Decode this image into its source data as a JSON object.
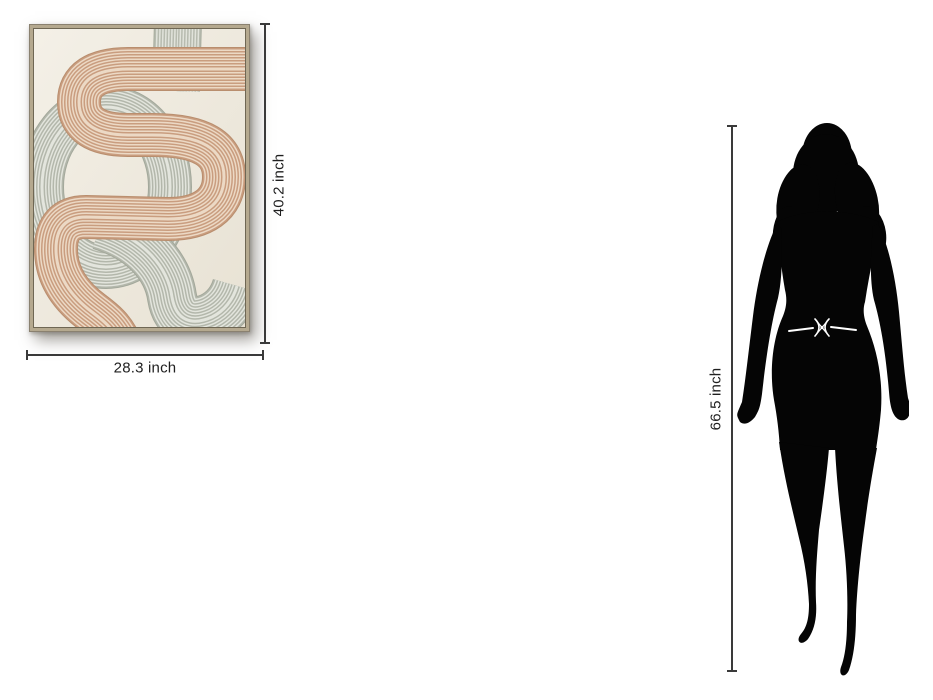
{
  "dimensions": {
    "artwork_height_label": "40.2 inch",
    "artwork_width_label": "28.3 inch",
    "person_height_label": "66.5 inch"
  },
  "colors": {
    "dimension_line": "#3a3a3a",
    "label_text": "#1f1f1f",
    "frame_wood": "#b5a98f",
    "canvas_background": "#f0ebe1",
    "ribbon_beige_dark": "#c99d7f",
    "ribbon_beige_light": "#ecd9c5",
    "ribbon_gray_dark": "#b3b7ab",
    "ribbon_gray_light": "#e3e5dd",
    "silhouette": "#050505"
  }
}
